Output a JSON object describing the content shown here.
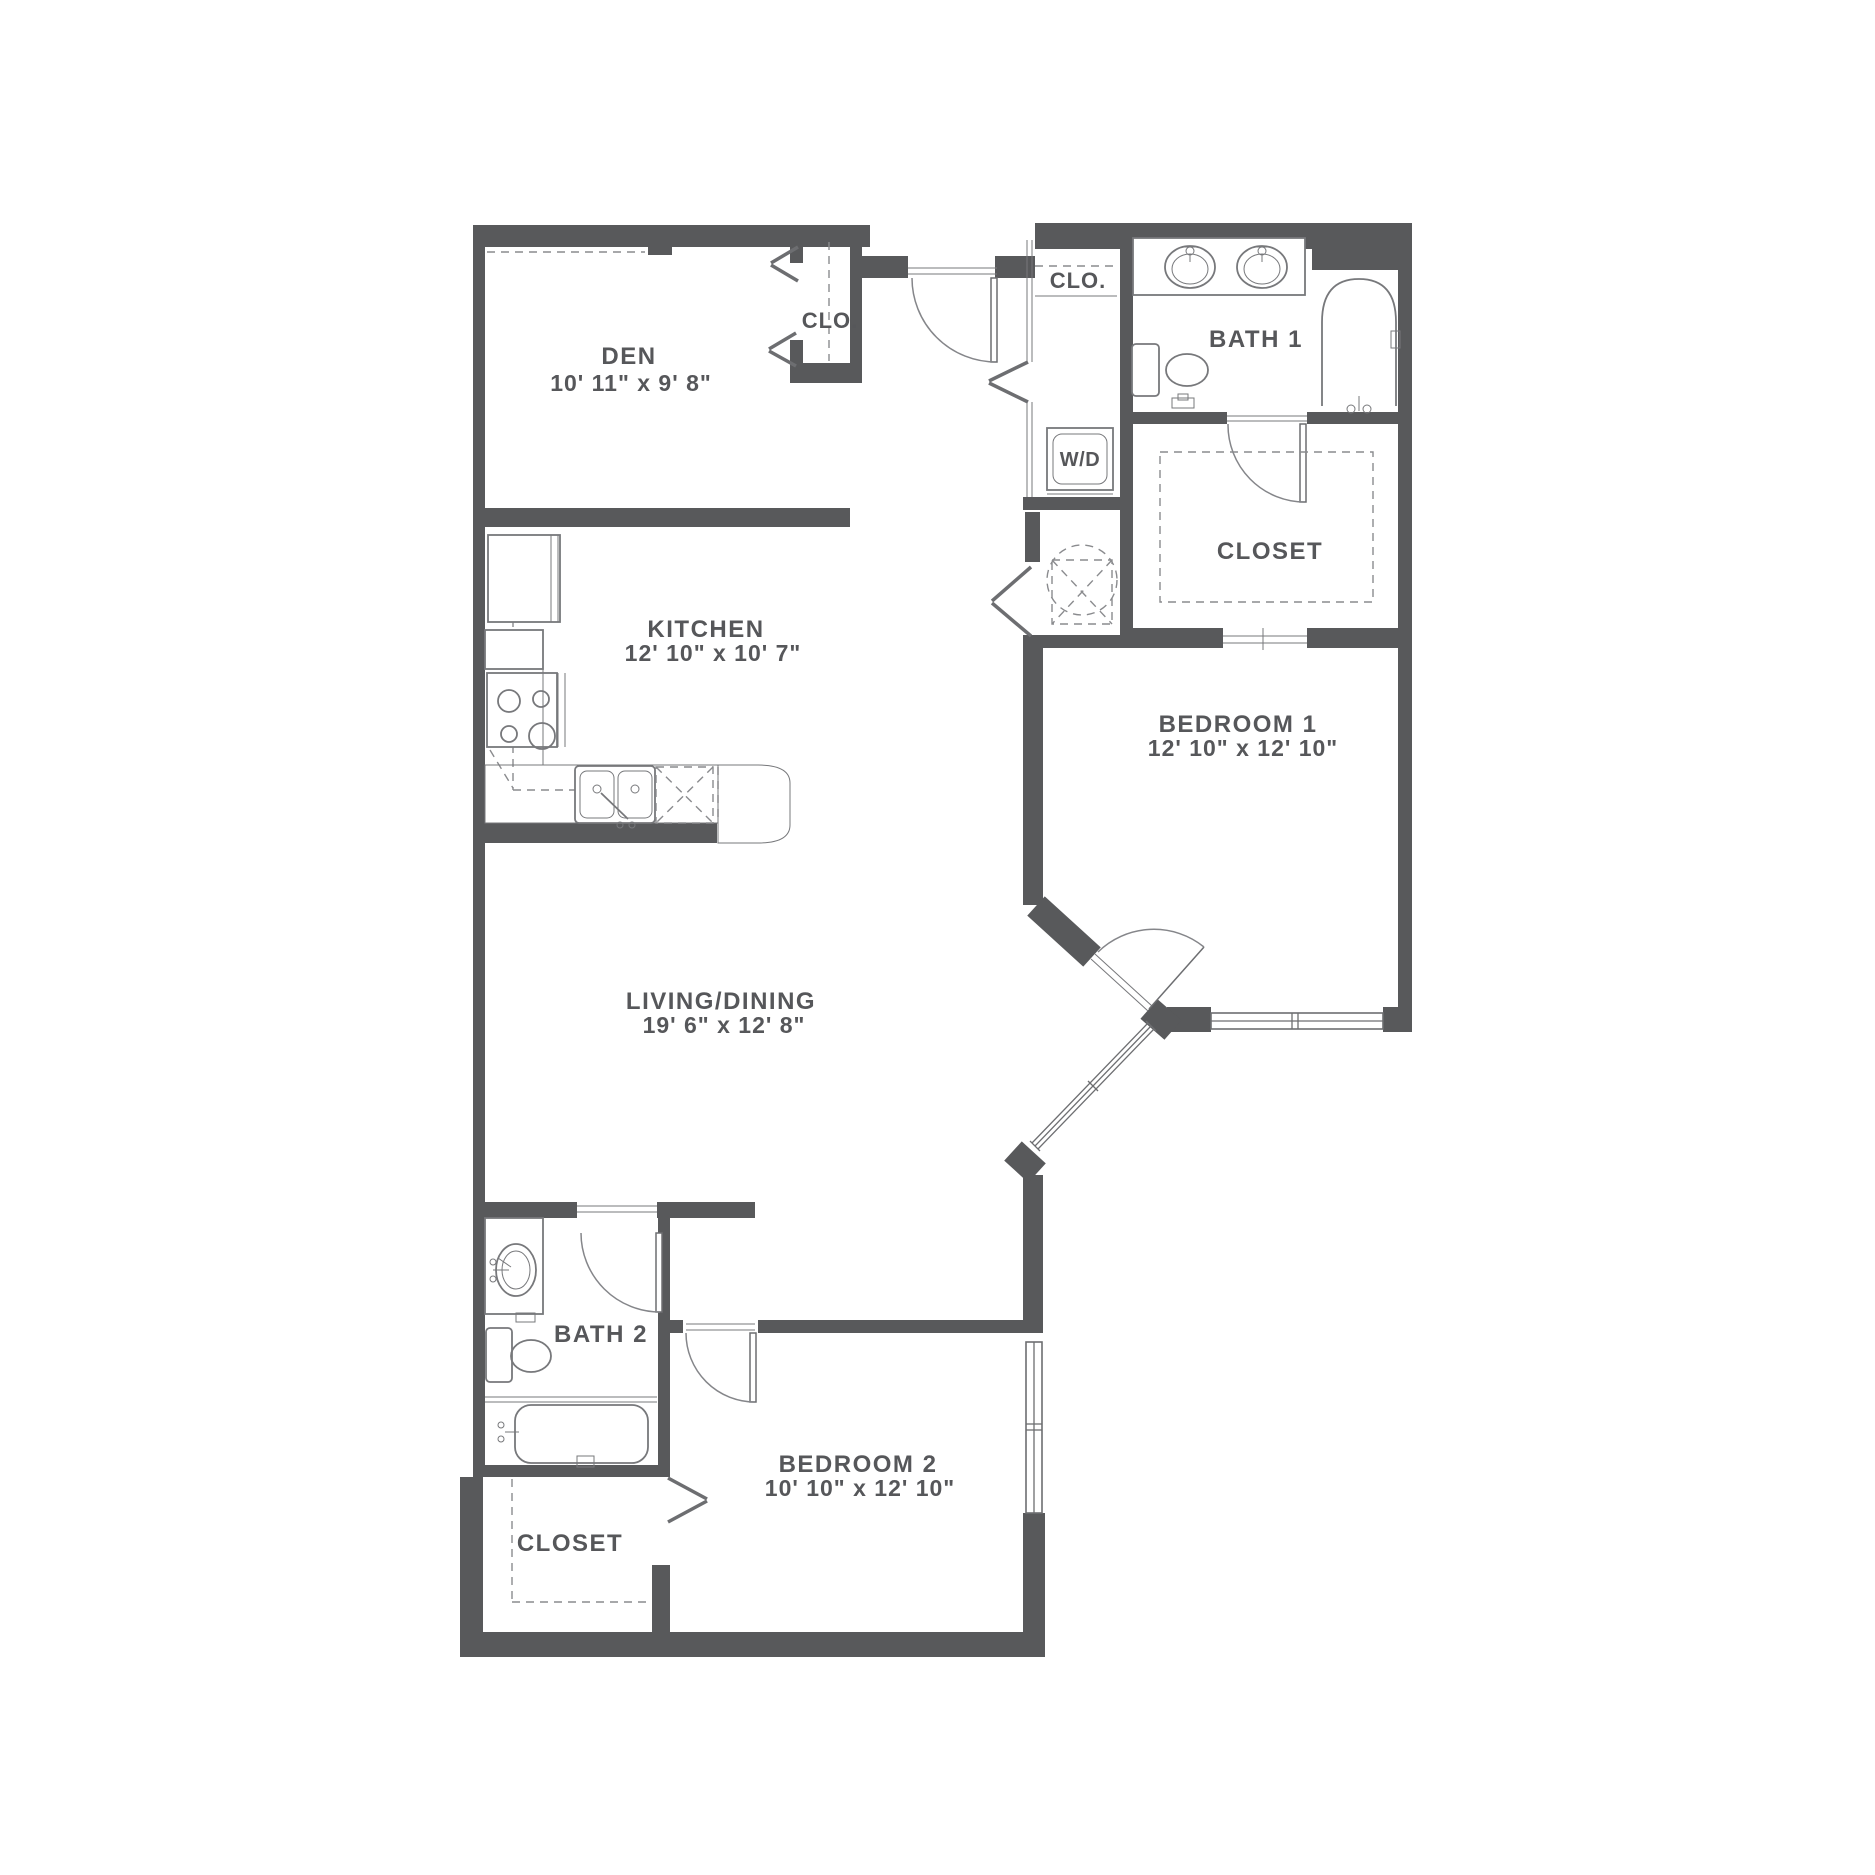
{
  "plan": {
    "type": "apartment-floor-plan",
    "wall_color": "#58595B",
    "label_color": "#56575A"
  },
  "rooms": {
    "den": {
      "name": "DEN",
      "dims": "10' 11\" x 9' 8\""
    },
    "den_closet": {
      "name": "CLO."
    },
    "entry_closet": {
      "name": "CLO."
    },
    "bath1": {
      "name": "BATH 1"
    },
    "laundry": {
      "name": "W/D"
    },
    "bath1_closet": {
      "name": "CLOSET"
    },
    "kitchen": {
      "name": "KITCHEN",
      "dims": "12' 10\" x 10' 7\""
    },
    "bedroom1": {
      "name": "BEDROOM 1",
      "dims": "12' 10\" x 12' 10\""
    },
    "living": {
      "name": "LIVING/DINING",
      "dims": "19' 6\" x 12' 8\""
    },
    "bath2": {
      "name": "BATH 2"
    },
    "bedroom2": {
      "name": "BEDROOM 2",
      "dims": "10' 10\" x 12' 10\""
    },
    "bedroom2_closet": {
      "name": "CLOSET"
    }
  }
}
